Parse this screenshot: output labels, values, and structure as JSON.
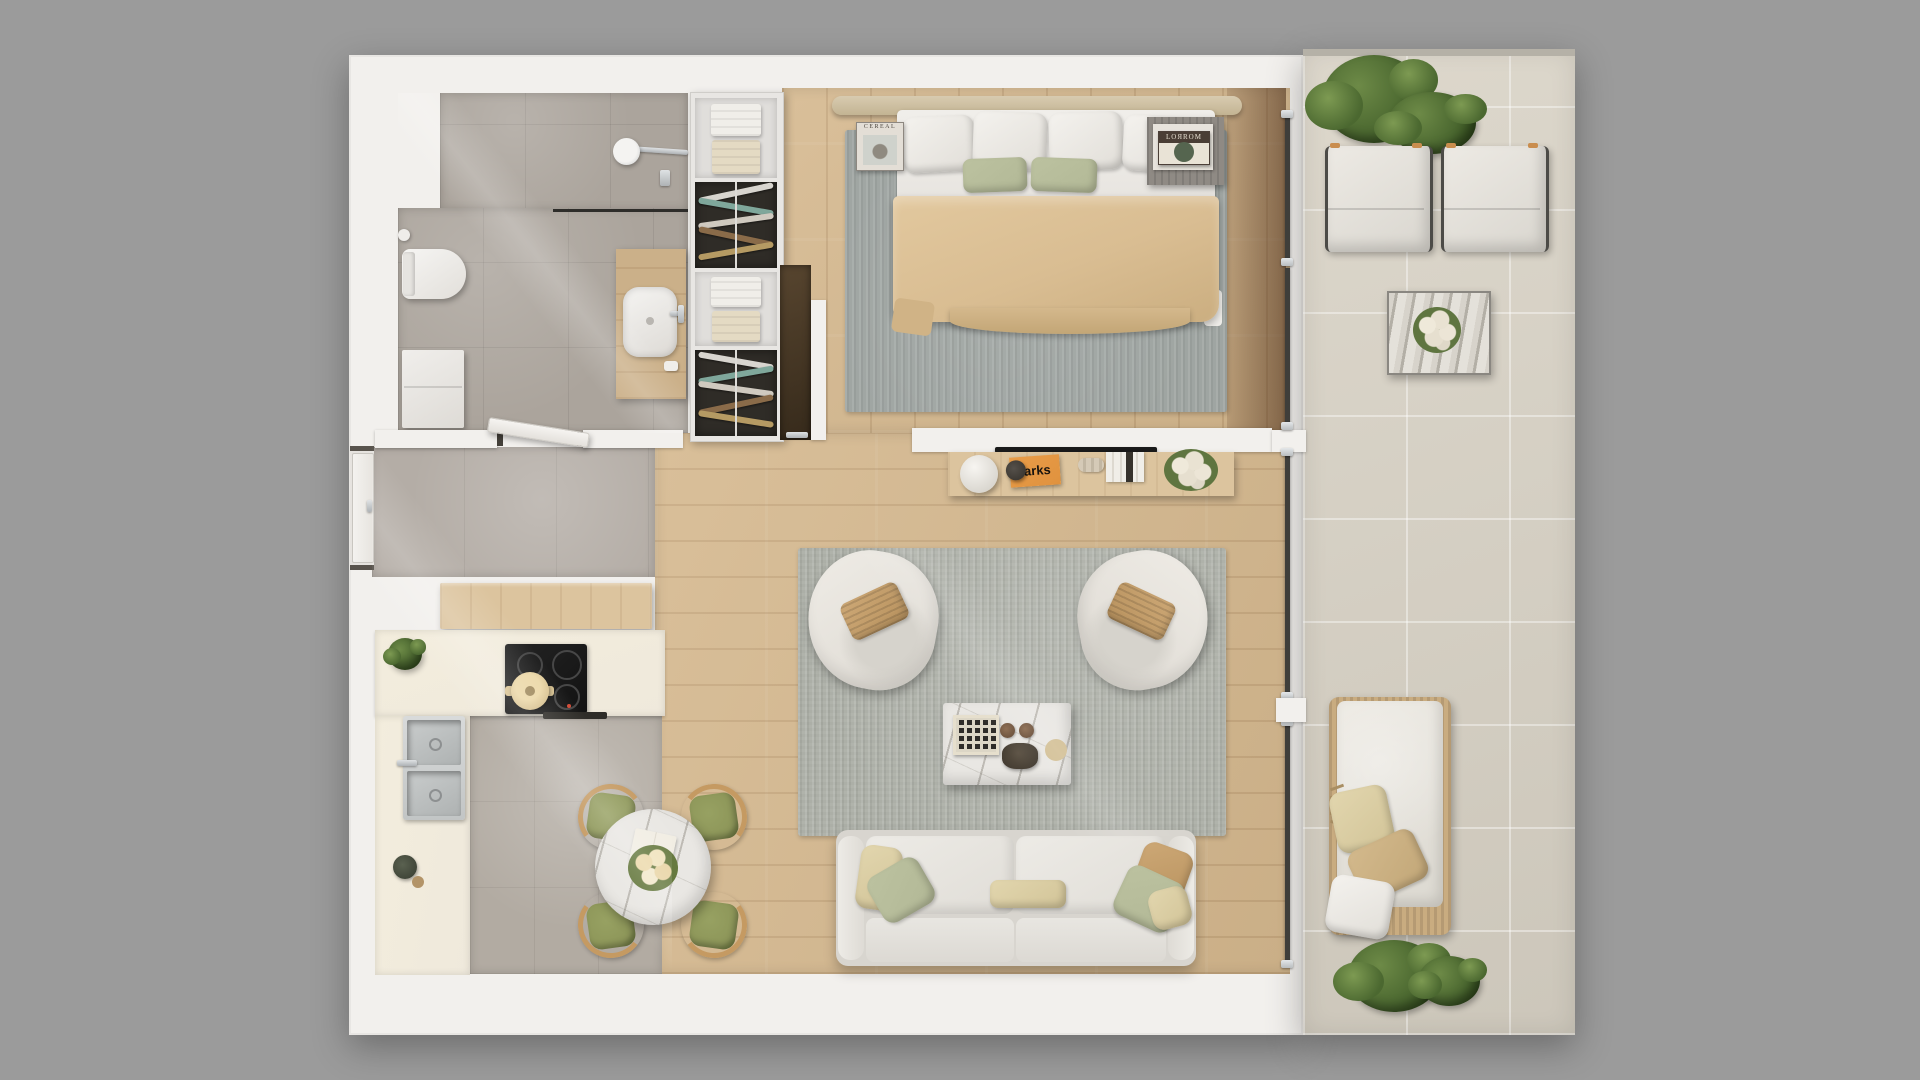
{
  "scene": {
    "title": "Apartment floor plan - top-down 3D render",
    "view": "top-down orthographic",
    "background": "#9b9b9b"
  },
  "palette": {
    "bg": "#9b9b9b",
    "wall": "#f2f0ed",
    "wood": "#d5b88e",
    "bath_tile": "#aba49c",
    "hall_tile": "#b4ada6",
    "kitchen_tile": "#b2aba2",
    "balcony_tile": "#d9d3c6",
    "rug_bedroom": "#9fa5a2",
    "rug_living": "#acafa7",
    "counter": "#efe9dc",
    "sofa": "#e6e4df",
    "blanket": "#d9bd92",
    "green_pillow": "#b2b896",
    "tan_pillow": "#c8955c",
    "plant": "#4e6b33",
    "marble": "#e9e7e3",
    "tv": "#1a1a1a",
    "orange_book": "#e0923e",
    "chair_cushion_green": "#8d9659",
    "glass": "#3f3e3a",
    "console_wood": "#dcc49e",
    "wicker": "#c9ac80",
    "bench": "#d8cbb0",
    "dark_section": "#2f2c27"
  },
  "rooms": {
    "bathroom": {
      "label": "bathroom",
      "items": [
        "shower head",
        "glass partition",
        "toilet",
        "storage cabinet",
        "wood vanity with vessel basin",
        "toilet-paper holder"
      ]
    },
    "hallway": {
      "label": "entry hallway",
      "items": [
        "entrance door",
        "open bathroom door",
        "wood sideboard"
      ]
    },
    "bedroom": {
      "label": "bedroom",
      "items": [
        "double bed with beige blanket",
        "headboard bench",
        "open wardrobe with shelves and rails",
        "gray rug",
        "nightstand with books",
        "magazine on rug",
        "pocket door panel"
      ]
    },
    "living_room": {
      "label": "living room",
      "items": [
        "two-seat sofa with pillows",
        "two boucle armchairs",
        "marble coffee table",
        "gray rug",
        "wall-mounted TV",
        "wood media console with lamp, books and flowers"
      ]
    },
    "kitchen": {
      "label": "kitchen",
      "items": [
        "L-shaped cream counter",
        "induction cooktop with pot",
        "double stainless sink",
        "round marble dining table",
        "four wood chairs with green cushions",
        "small plant",
        "grinder set"
      ]
    },
    "balcony": {
      "label": "balcony terrace",
      "items": [
        "two cushioned lounge chairs",
        "marble side table with white bouquet",
        "rattan daybed with pillows",
        "four potted green plants",
        "floor-to-ceiling glass wall"
      ]
    }
  },
  "texts": {
    "magazine_cover": "CEREAL",
    "orange_book": "arks",
    "bedroom_book": "LOЯROM"
  }
}
